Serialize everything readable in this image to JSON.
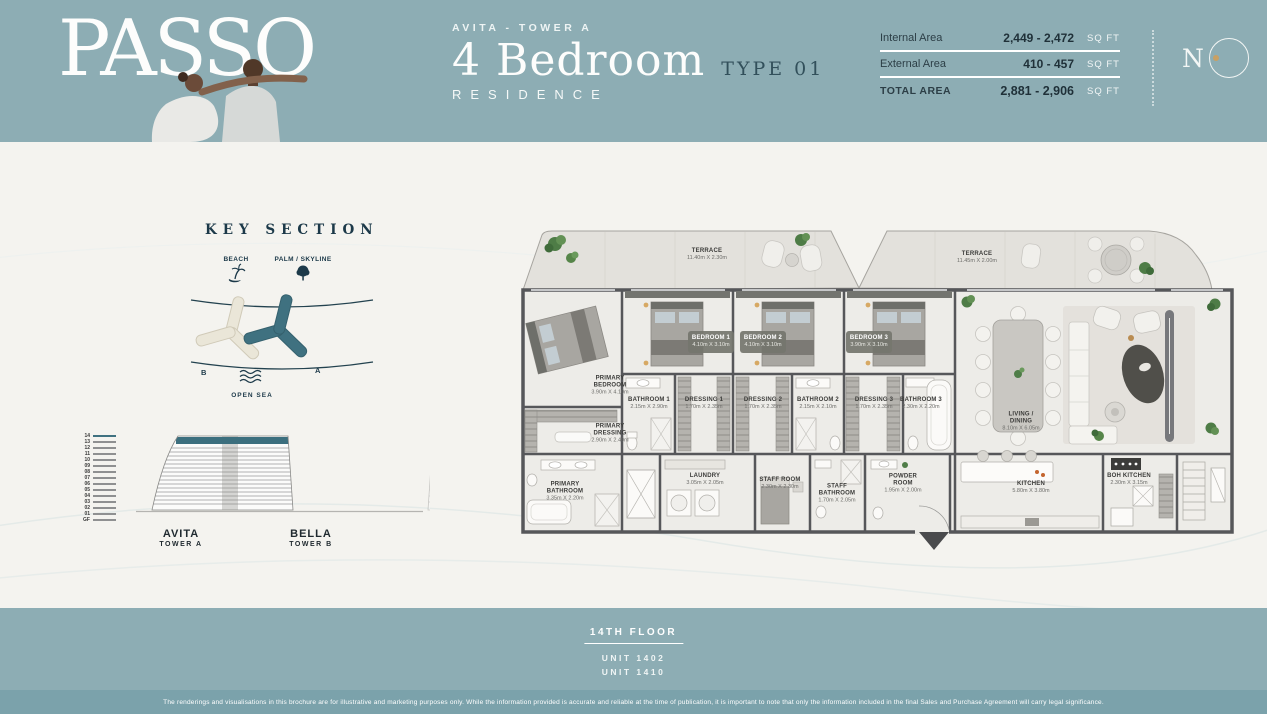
{
  "colors": {
    "band": "#8dadb4",
    "band_dark": "#7ba2ab",
    "navy": "#1c3949",
    "accent_gold": "#c9a063",
    "tower_teal": "#3f7180",
    "tower_beige": "#eae6d8"
  },
  "header": {
    "brand": "PASSO",
    "tower_line": "AVITA - TOWER A",
    "residence_title": "4 Bedroom",
    "type_label": "TYPE 01",
    "residence_sub": "RESIDENCE",
    "area_table": {
      "rows": [
        {
          "label": "Internal Area",
          "value": "2,449 - 2,472",
          "unit": "SQ FT",
          "emphasis": false
        },
        {
          "label": "External Area",
          "value": "410 - 457",
          "unit": "SQ FT",
          "emphasis": false
        },
        {
          "label": "TOTAL AREA",
          "value": "2,881 - 2,906",
          "unit": "SQ FT",
          "emphasis": true
        }
      ]
    },
    "dev_logo_letter": "N"
  },
  "key_section": {
    "title": "KEY SECTION",
    "legend": [
      {
        "label": "BEACH",
        "icon": "palm-island-icon"
      },
      {
        "label": "PALM / SKYLINE",
        "icon": "tree-icon"
      }
    ],
    "towers": [
      {
        "label": "B"
      },
      {
        "label": "A"
      }
    ],
    "open_sea_label": "OPEN SEA"
  },
  "elevation": {
    "floors": [
      "14",
      "13",
      "12",
      "11",
      "10",
      "09",
      "08",
      "07",
      "06",
      "05",
      "04",
      "03",
      "02",
      "01",
      "GF"
    ],
    "towers": [
      {
        "name": "AVITA",
        "sub": "TOWER A"
      },
      {
        "name": "BELLA",
        "sub": "TOWER B"
      }
    ]
  },
  "floorplan": {
    "rooms": [
      {
        "id": "terrace-left",
        "label": "TERRACE",
        "dims": "11.40m X 2.30m",
        "x": 192,
        "y": 33,
        "light": false
      },
      {
        "id": "terrace-right",
        "label": "TERRACE",
        "dims": "11.45m X 2.00m",
        "x": 462,
        "y": 36,
        "light": false
      },
      {
        "id": "primary-bedroom",
        "label": "PRIMARY BEDROOM",
        "dims": "3.90m X 4.10m",
        "x": 95,
        "y": 164,
        "light": false
      },
      {
        "id": "bedroom-1",
        "label": "BEDROOM 1",
        "dims": "4.10m X 3.10m",
        "x": 196,
        "y": 120,
        "light": true
      },
      {
        "id": "bedroom-2",
        "label": "BEDROOM 2",
        "dims": "4.10m X 3.10m",
        "x": 248,
        "y": 120,
        "light": true
      },
      {
        "id": "bedroom-3",
        "label": "BEDROOM 3",
        "dims": "3.90m X 3.10m",
        "x": 354,
        "y": 120,
        "light": true
      },
      {
        "id": "bathroom-1",
        "label": "BATHROOM 1",
        "dims": "2.15m X 2.90m",
        "x": 134,
        "y": 182,
        "light": false
      },
      {
        "id": "dressing-1",
        "label": "DRESSING 1",
        "dims": "1.70m X 2.35m",
        "x": 189,
        "y": 182,
        "light": false
      },
      {
        "id": "dressing-2",
        "label": "DRESSING 2",
        "dims": "1.70m X 2.35m",
        "x": 248,
        "y": 182,
        "light": false
      },
      {
        "id": "bathroom-2",
        "label": "BATHROOM 2",
        "dims": "2.15m X 2.10m",
        "x": 303,
        "y": 182,
        "light": false
      },
      {
        "id": "dressing-3",
        "label": "DRESSING 3",
        "dims": "1.70m X 2.35m",
        "x": 359,
        "y": 182,
        "light": false
      },
      {
        "id": "bathroom-3",
        "label": "BATHROOM 3",
        "dims": "2.30m X 2.20m",
        "x": 406,
        "y": 182,
        "light": false
      },
      {
        "id": "primary-dressing",
        "label": "PRIMARY DRESSING",
        "dims": "2.90m X 2.40m",
        "x": 95,
        "y": 212,
        "light": false
      },
      {
        "id": "primary-bathroom",
        "label": "PRIMARY BATHROOM",
        "dims": "3.35m X 2.20m",
        "x": 50,
        "y": 270,
        "light": false
      },
      {
        "id": "laundry",
        "label": "LAUNDRY",
        "dims": "3.05m X 2.05m",
        "x": 190,
        "y": 258,
        "light": false
      },
      {
        "id": "staff-room",
        "label": "STAFF ROOM",
        "dims": "2.30m X 2.30m",
        "x": 265,
        "y": 262,
        "light": false
      },
      {
        "id": "staff-bathroom",
        "label": "STAFF BATHROOM",
        "dims": "1.70m X 2.05m",
        "x": 322,
        "y": 272,
        "light": false
      },
      {
        "id": "powder-room",
        "label": "POWDER ROOM",
        "dims": "1.95m X 2.00m",
        "x": 388,
        "y": 262,
        "light": false
      },
      {
        "id": "living-dining",
        "label": "LIVING / DINING",
        "dims": "8.10m X 6.05m",
        "x": 506,
        "y": 200,
        "light": false
      },
      {
        "id": "kitchen",
        "label": "KITCHEN",
        "dims": "5.80m X 3.80m",
        "x": 516,
        "y": 266,
        "light": false
      },
      {
        "id": "boh-kitchen",
        "label": "BOH KITCHEN",
        "dims": "2.30m X 3.15m",
        "x": 614,
        "y": 258,
        "light": false
      }
    ]
  },
  "footer": {
    "floor_label": "14TH FLOOR",
    "units": [
      "UNIT 1402",
      "UNIT 1410"
    ],
    "disclaimer": "The renderings and visualisations in this brochure are for illustrative and marketing purposes only. While the information provided is accurate and reliable at the time of publication, it is important to note that only the information included in the final Sales and Purchase Agreement will carry legal significance."
  }
}
